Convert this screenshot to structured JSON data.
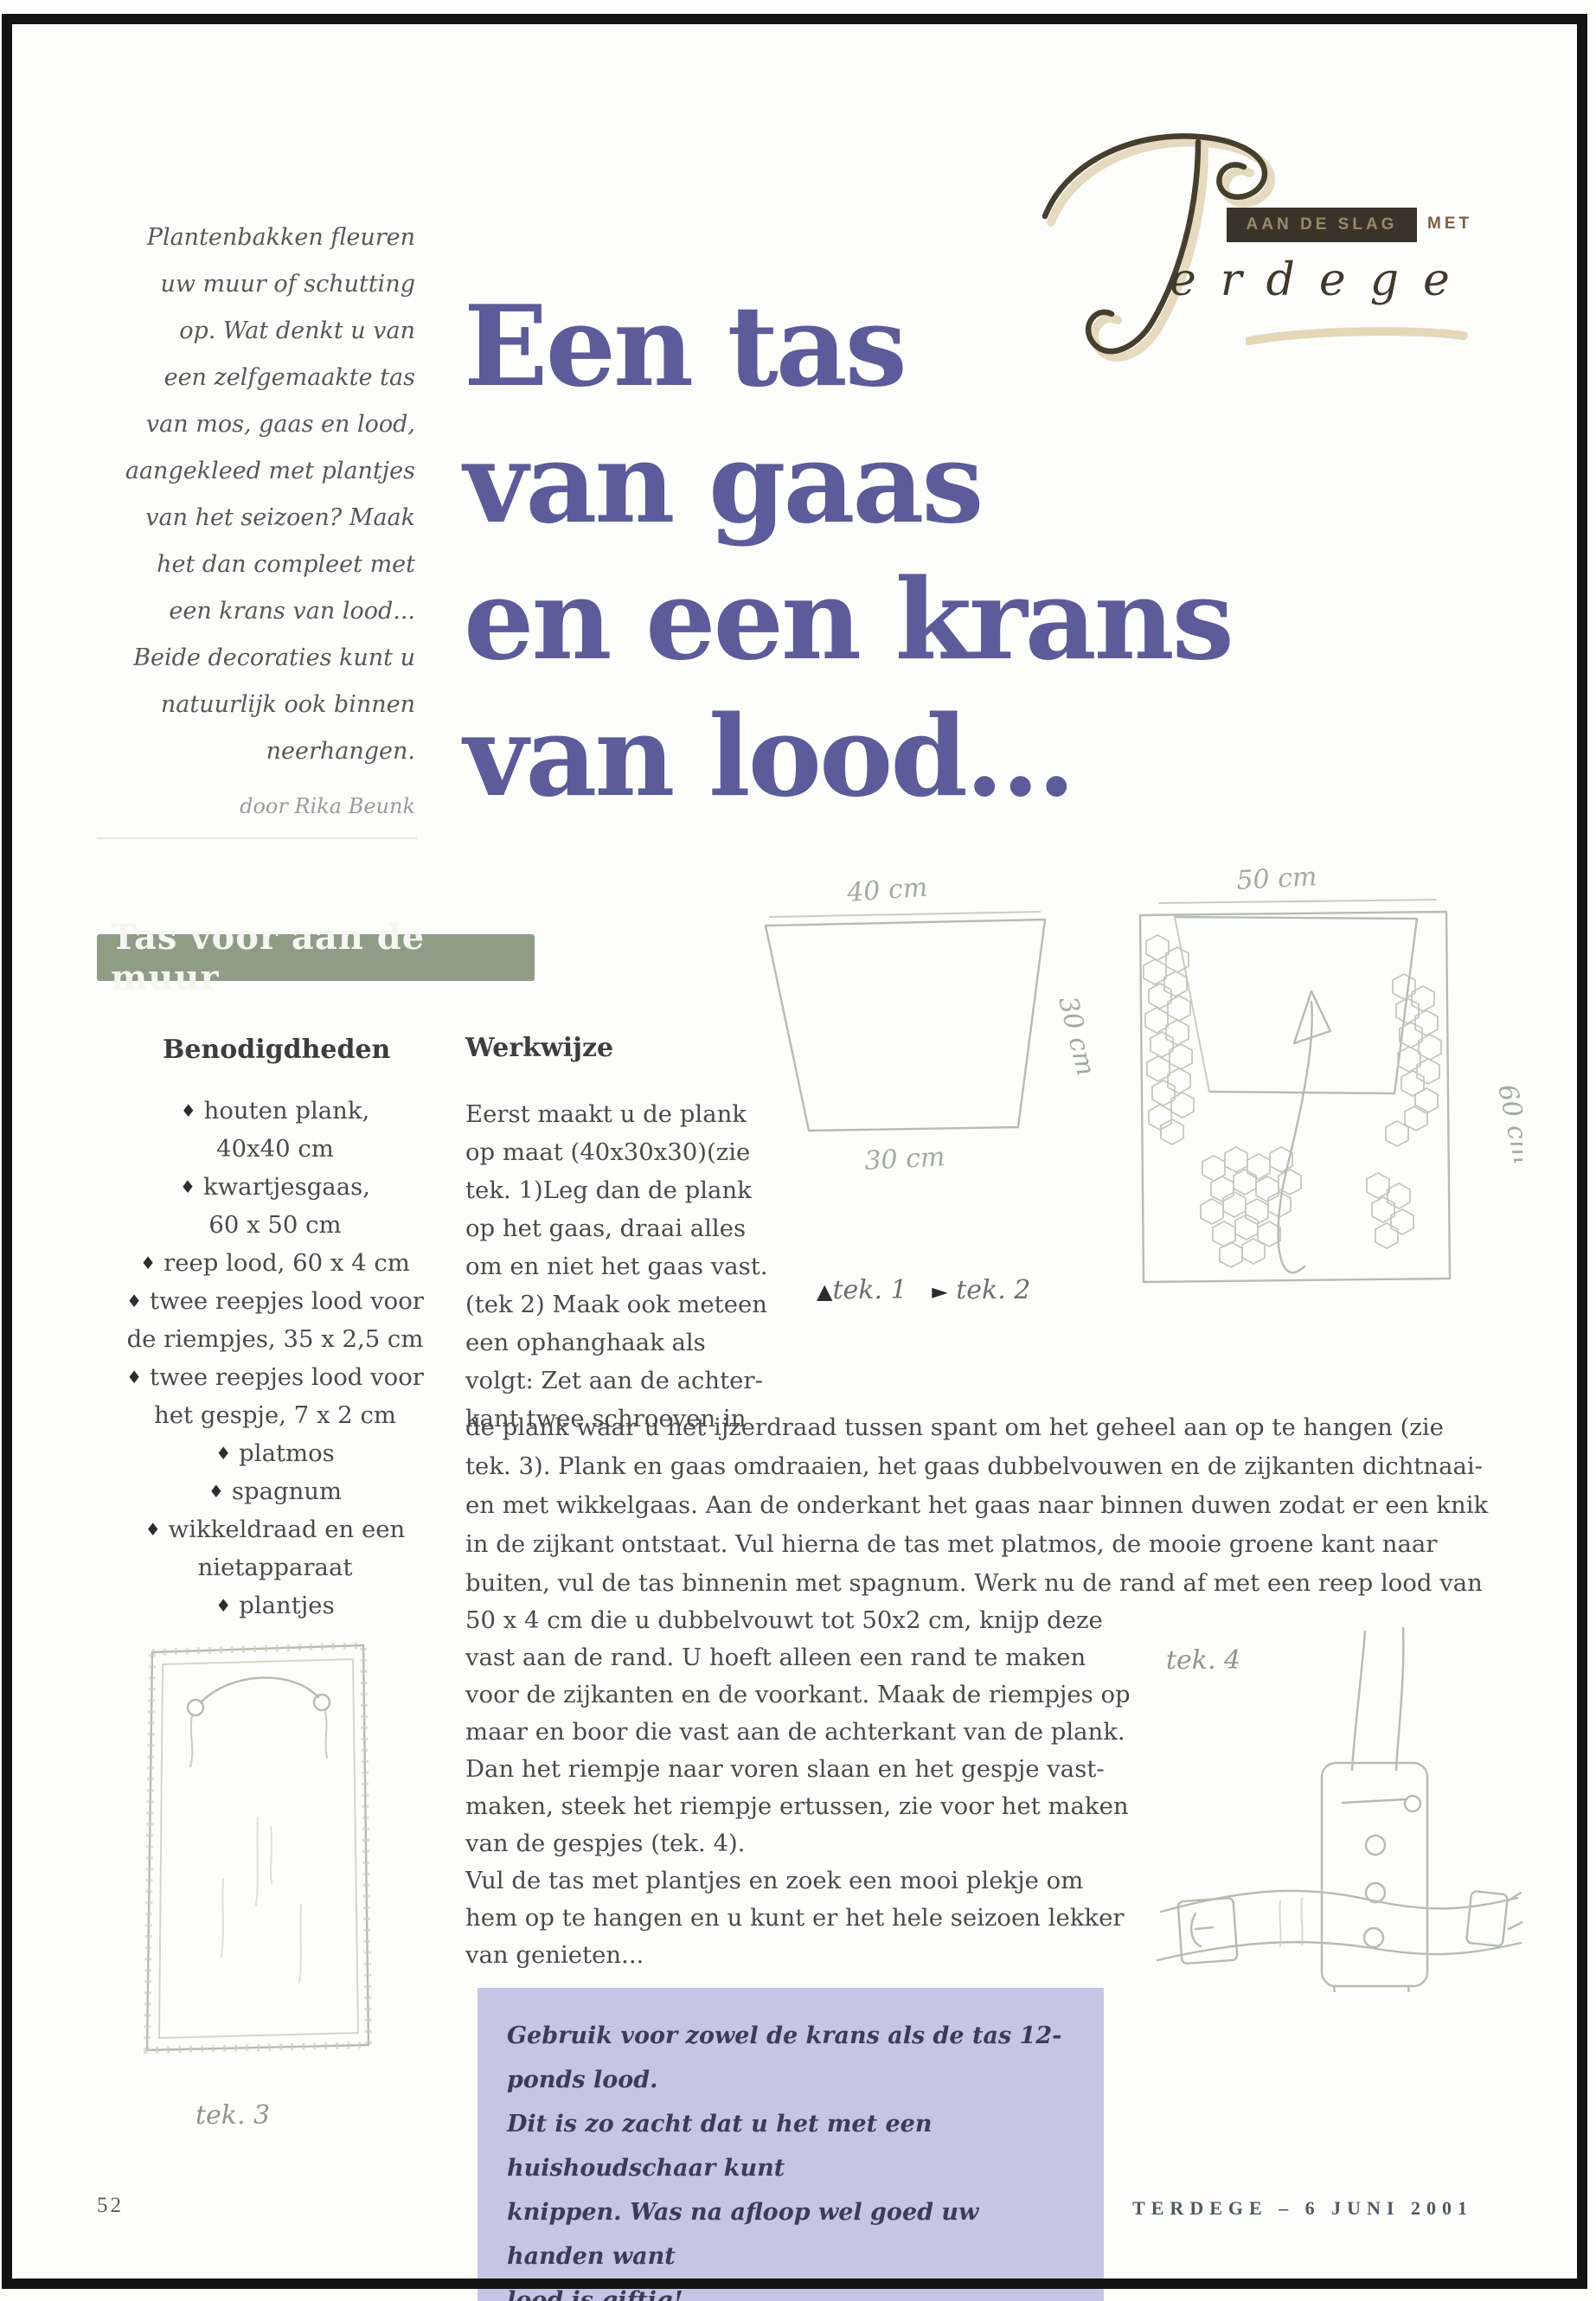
{
  "page": {
    "number": "52",
    "footer": "TERDEGE – 6 JUNI 2001"
  },
  "masthead": {
    "badge": "AAN DE SLAG",
    "badge_suffix": "MET",
    "script_rest": "erdege"
  },
  "intro": {
    "text": "Plantenbakken fleuren\nuw muur of schutting\nop. Wat denkt u van\neen zelfgemaakte tas\nvan mos, gaas en lood,\naangekleed met plantjes\nvan het seizoen? Maak\nhet dan compleet met\neen krans van lood...\nBeide decoraties kunt u\nnatuurlijk ook binnen\nneerhangen.",
    "byline": "door Rika Beunk"
  },
  "title": {
    "lines": [
      "Een tas",
      "van gaas",
      "en een krans",
      "van lood..."
    ]
  },
  "section": {
    "banner": "Tas voor aan de muur"
  },
  "materials": {
    "heading": "Benodigdheden",
    "items": [
      "houten plank,\n40x40 cm",
      "kwartjesgaas,\n60 x 50 cm",
      "reep lood, 60 x 4 cm",
      "twee reepjes lood voor\nde riempjes, 35 x 2,5 cm",
      "twee reepjes lood voor\nhet gespje, 7 x 2 cm",
      "platmos",
      "spagnum",
      "wikkeldraad en een\nnietapparaat",
      "plantjes"
    ]
  },
  "method": {
    "heading": "Werkwijze",
    "col1": "Eerst maakt u de plank\nop maat (40x30x30)(zie\ntek. 1)Leg dan de plank\nop het gaas, draai alles\nom en niet het gaas vast.\n(tek 2) Maak  ook meteen\neen ophanghaak als\nvolgt: Zet aan de achter-\nkant twee schroeven in",
    "wide": "de plank waar u het ijzerdraad tussen spant om het geheel aan op te hangen (zie\ntek. 3).  Plank en gaas omdraaien, het gaas dubbelvouwen en de zijkanten dichtnaai-\nen met wikkelgaas. Aan de onderkant het gaas naar binnen duwen zodat er een knik\nin de zijkant ontstaat. Vul hierna de tas met platmos, de mooie groene kant naar\nbuiten, vul de tas binnenin met spagnum. Werk nu de rand af met een reep lood van",
    "col2": "50 x 4 cm die u dubbelvouwt tot 50x2 cm, knijp deze\nvast aan de rand. U hoeft alleen een rand te maken\nvoor de zijkanten en de voorkant. Maak de riempjes op\nmaar en boor die vast aan de achterkant van de plank.\nDan het riempje naar voren slaan en het gespje vast-\nmaken, steek het riempje ertussen, zie voor het maken\nvan de gespjes (tek. 4).\nVul de tas met plantjes en zoek een mooi plekje om\nhem op te hangen en u kunt er het hele seizoen lekker\nvan genieten..."
  },
  "figures": {
    "fig1": {
      "dim_top": "40 cm",
      "dim_bottom": "30 cm",
      "dim_side": "30 cm"
    },
    "fig2": {
      "dim_top": "50 cm",
      "dim_side": "60 cm"
    },
    "caption": {
      "marker1": "▲",
      "label1": "tek. 1",
      "marker2": "►",
      "label2": "tek. 2"
    },
    "fig3_label": "tek. 3",
    "fig4_label": "tek. 4"
  },
  "note": {
    "text": "Gebruik voor zowel de krans als de tas 12-ponds lood.\nDit is zo zacht dat u het met een huishoudschaar kunt\nknippen. Was na afloop wel goed uw handen want\nlood is giftig!"
  },
  "colors": {
    "title": "#5c5c9a",
    "banner": "#8f9d87",
    "note_bg": "#c7c5e5",
    "badge_bg": "#3a332a",
    "sketch": "#b5bdaf"
  }
}
